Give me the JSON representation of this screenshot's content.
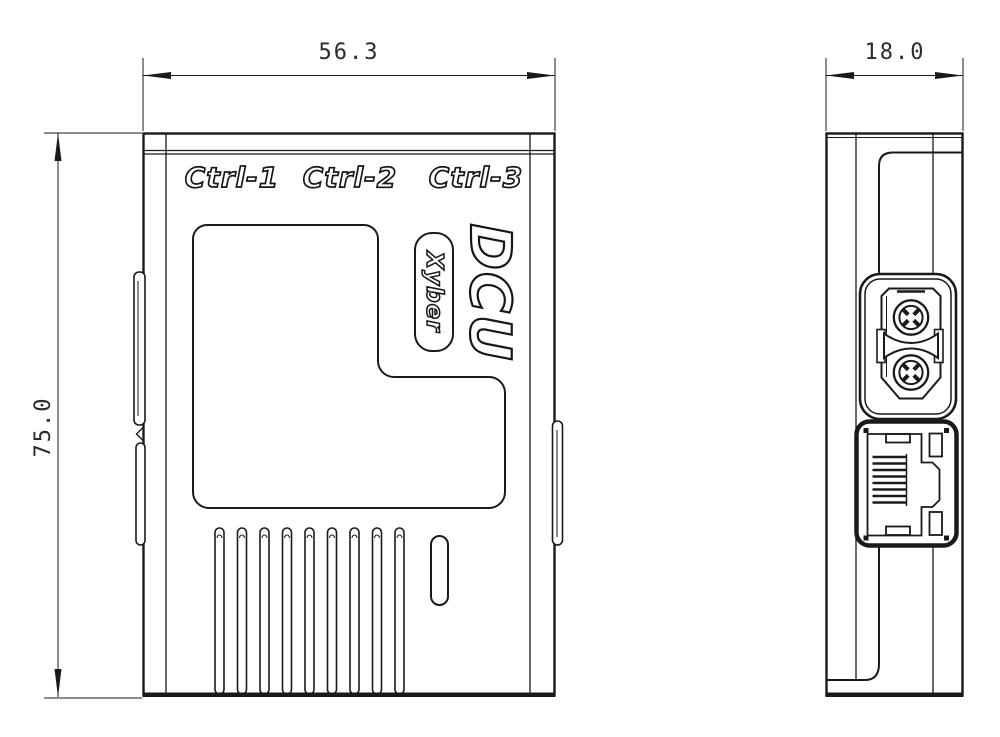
{
  "drawing": {
    "views": {
      "front": {
        "port_labels": [
          "Ctrl-1",
          "Ctrl-2",
          "Ctrl-3"
        ],
        "model_label": "DCU",
        "brand_label": "Xyber",
        "width_mm": "56.3",
        "height_mm": "75.0"
      },
      "side": {
        "depth_mm": "18.0",
        "connectors": [
          "xt30-power-connector",
          "rj45-ethernet-port"
        ]
      }
    },
    "colors": {
      "line": "#1a1a1a",
      "background": "#ffffff"
    }
  }
}
